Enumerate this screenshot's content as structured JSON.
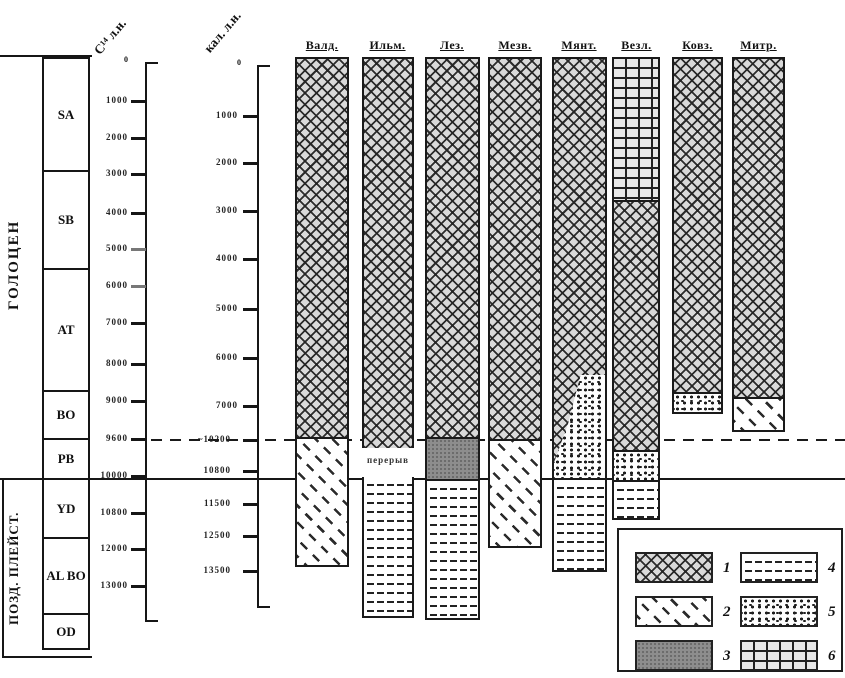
{
  "figure": {
    "epochs": {
      "holocene": "ГОЛОЦЕН",
      "late_pleistocene": "ПОЗД. ПЛЕЙСТ."
    },
    "zones": [
      "SA",
      "SB",
      "AT",
      "BO",
      "PB",
      "YD",
      "AL BO",
      "OD"
    ],
    "scales": {
      "c14": {
        "title": "С¹⁴ л.н.",
        "zero": "0",
        "ticks": [
          "1000",
          "2000",
          "3000",
          "4000",
          "5000",
          "6000",
          "7000",
          "8000",
          "9000",
          "9600",
          "10000",
          "10800",
          "12000",
          "13000"
        ]
      },
      "cal": {
        "title": "кал. л.н.",
        "zero": "0",
        "ticks": [
          "1000",
          "2000",
          "3000",
          "4000",
          "5000",
          "6000",
          "7000",
          "~10200",
          "10800",
          "11500",
          "12500",
          "13500"
        ]
      }
    },
    "columns": [
      {
        "name": "Валд.",
        "segments": "1, 2"
      },
      {
        "name": "Ильм.",
        "segments": "1, перерыв, 4"
      },
      {
        "name": "Лез.",
        "segments": "1, 3, 4"
      },
      {
        "name": "Мезв.",
        "segments": "1, 2"
      },
      {
        "name": "Мянт.",
        "segments": "1, 5, 4"
      },
      {
        "name": "Везл.",
        "segments": "6, 1, 5, 4"
      },
      {
        "name": "Ковз.",
        "segments": "1, 5"
      },
      {
        "name": "Митр.",
        "segments": "1, 2"
      }
    ],
    "hiatus_label": "перерыв",
    "legend": {
      "items": [
        {
          "num": "1",
          "pattern": "crosshatch"
        },
        {
          "num": "2",
          "pattern": "diagonal-dashes"
        },
        {
          "num": "3",
          "pattern": "solid-gray"
        },
        {
          "num": "4",
          "pattern": "horizontal-dashes"
        },
        {
          "num": "5",
          "pattern": "stipple-dots"
        },
        {
          "num": "6",
          "pattern": "grid"
        }
      ]
    }
  }
}
